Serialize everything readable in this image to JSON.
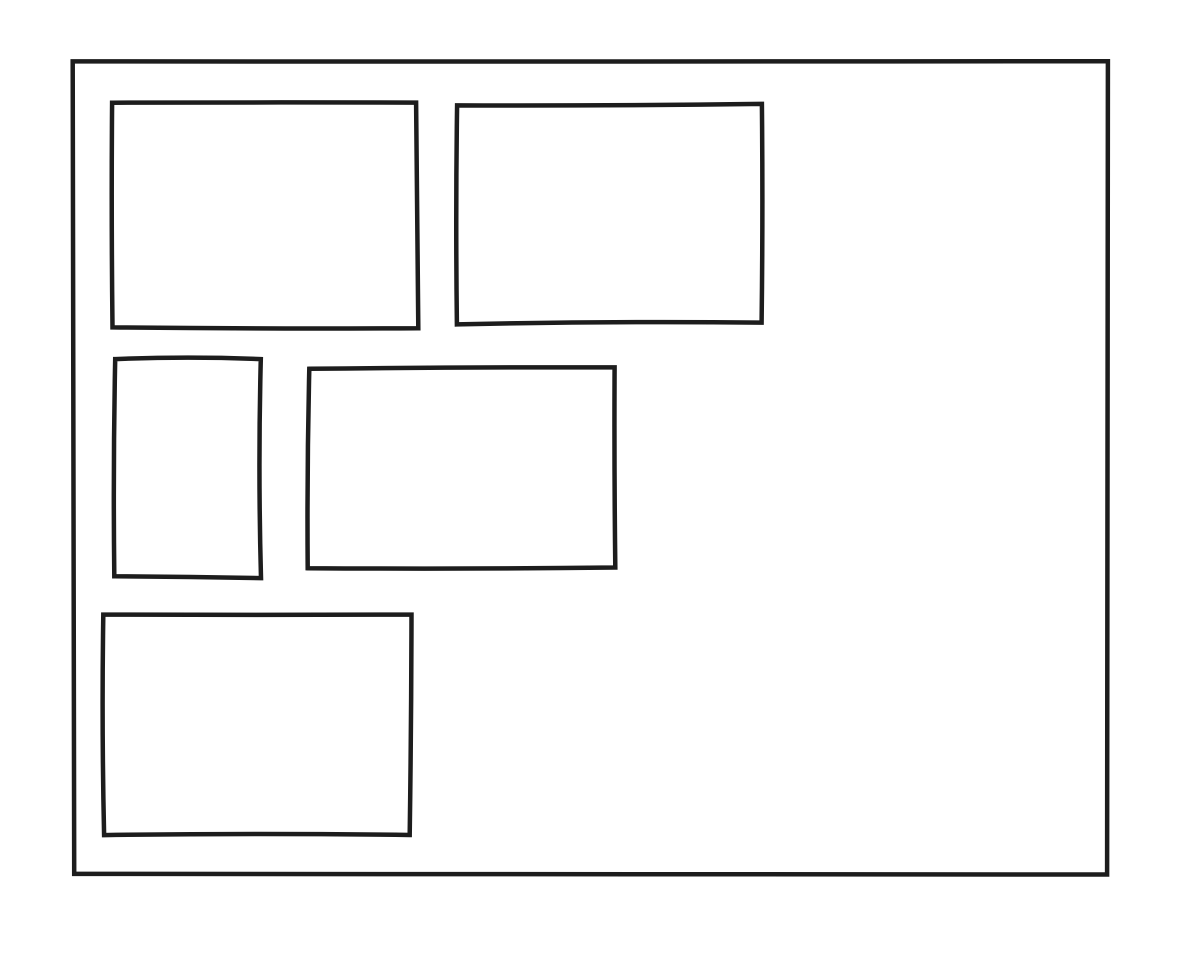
{
  "canvas": {
    "width": 1192,
    "height": 956,
    "background": "#ffffff",
    "stroke_color": "#1d1d1d"
  },
  "sketch": {
    "description": "hand-drawn wireframe: outer frame containing five empty rectangles",
    "frame": {
      "name": "outer-frame",
      "x": 73,
      "y": 61,
      "w": 1035,
      "h": 812,
      "stroke_width": 4.5,
      "wobble": 2.5
    },
    "boxes": [
      {
        "name": "box-top-left",
        "x": 112,
        "y": 104,
        "w": 305,
        "h": 223,
        "stroke_width": 4.5,
        "wobble": 2.5
      },
      {
        "name": "box-top-right",
        "x": 457,
        "y": 104,
        "w": 306,
        "h": 219,
        "stroke_width": 4.5,
        "wobble": 3.0
      },
      {
        "name": "box-middle-left",
        "x": 115,
        "y": 358,
        "w": 147,
        "h": 219,
        "stroke_width": 4.5,
        "wobble": 3.0
      },
      {
        "name": "box-middle-center",
        "x": 309,
        "y": 368,
        "w": 307,
        "h": 200,
        "stroke_width": 4.5,
        "wobble": 2.5
      },
      {
        "name": "box-bottom-left",
        "x": 103,
        "y": 614,
        "w": 307,
        "h": 220,
        "stroke_width": 4.5,
        "wobble": 3.0
      }
    ]
  }
}
